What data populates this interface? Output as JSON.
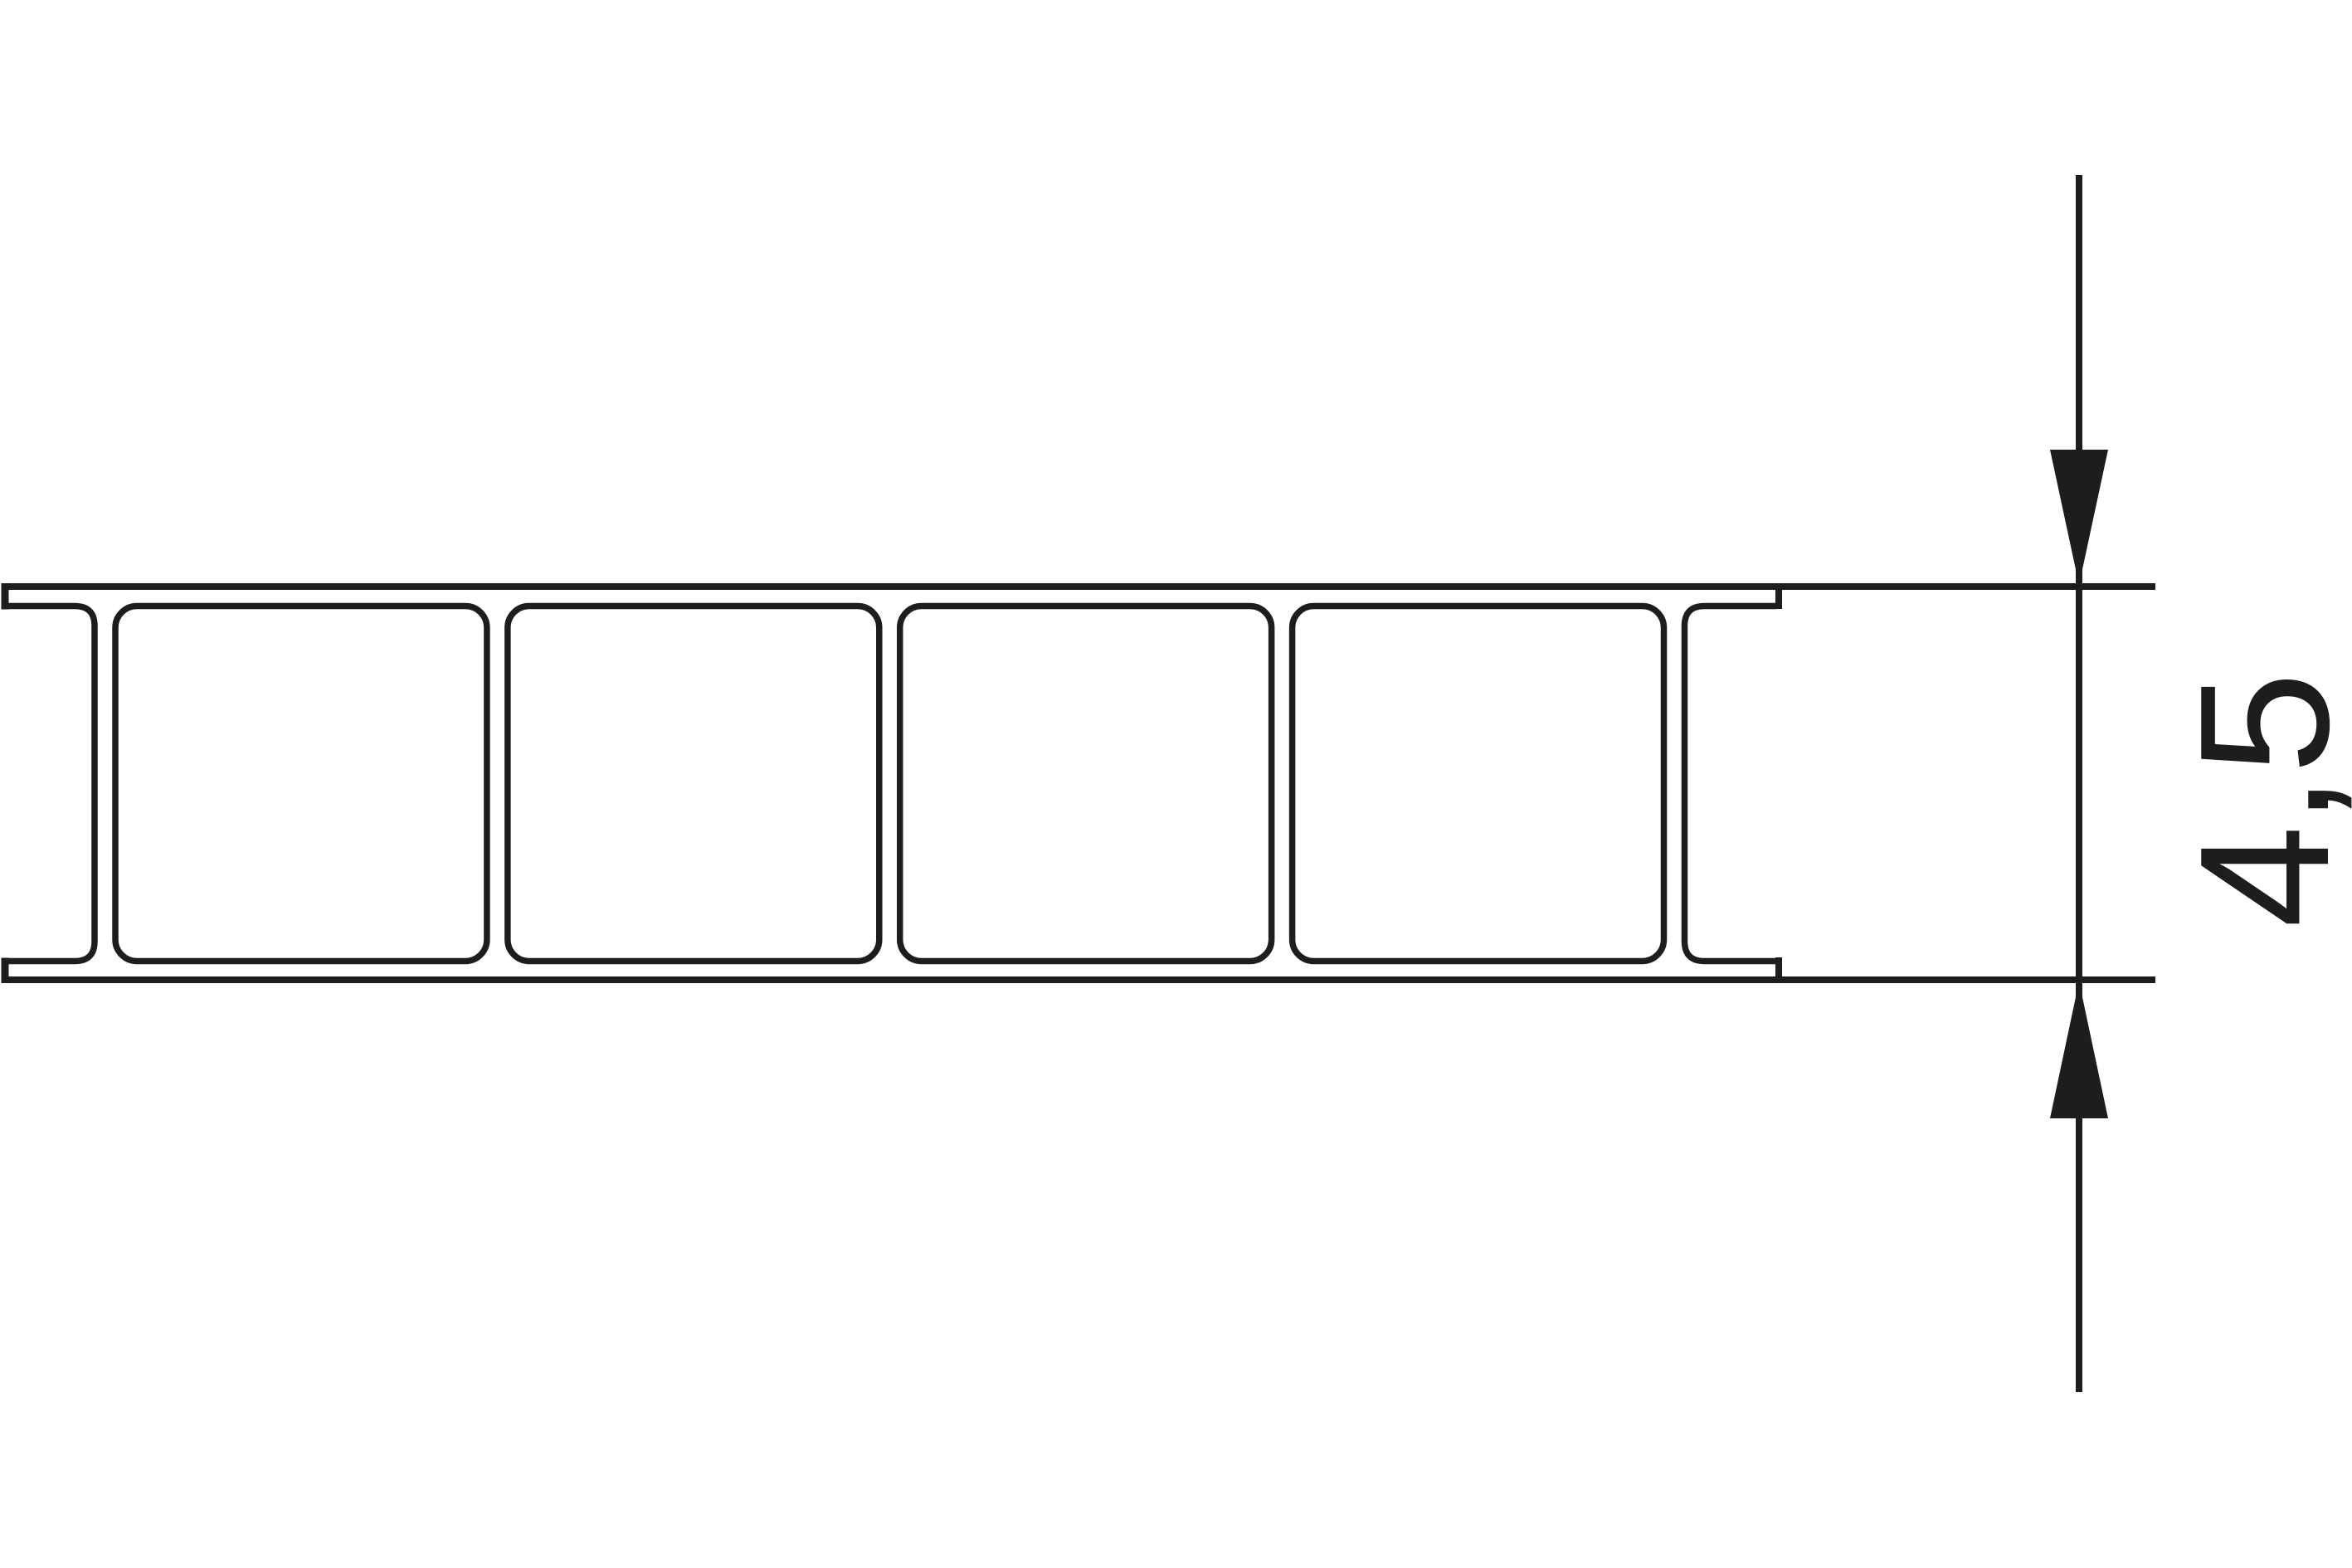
{
  "drawing": {
    "background_color": "#ffffff",
    "ink_color": "#1d1d1b",
    "panel": {
      "description": "hollow-chamber twin-wall sheet cross-section",
      "full_cell_count": 4,
      "left_partial_cell": true,
      "right_partial_cell": true
    },
    "dimension": {
      "label": "4,5",
      "orientation": "vertical"
    }
  }
}
